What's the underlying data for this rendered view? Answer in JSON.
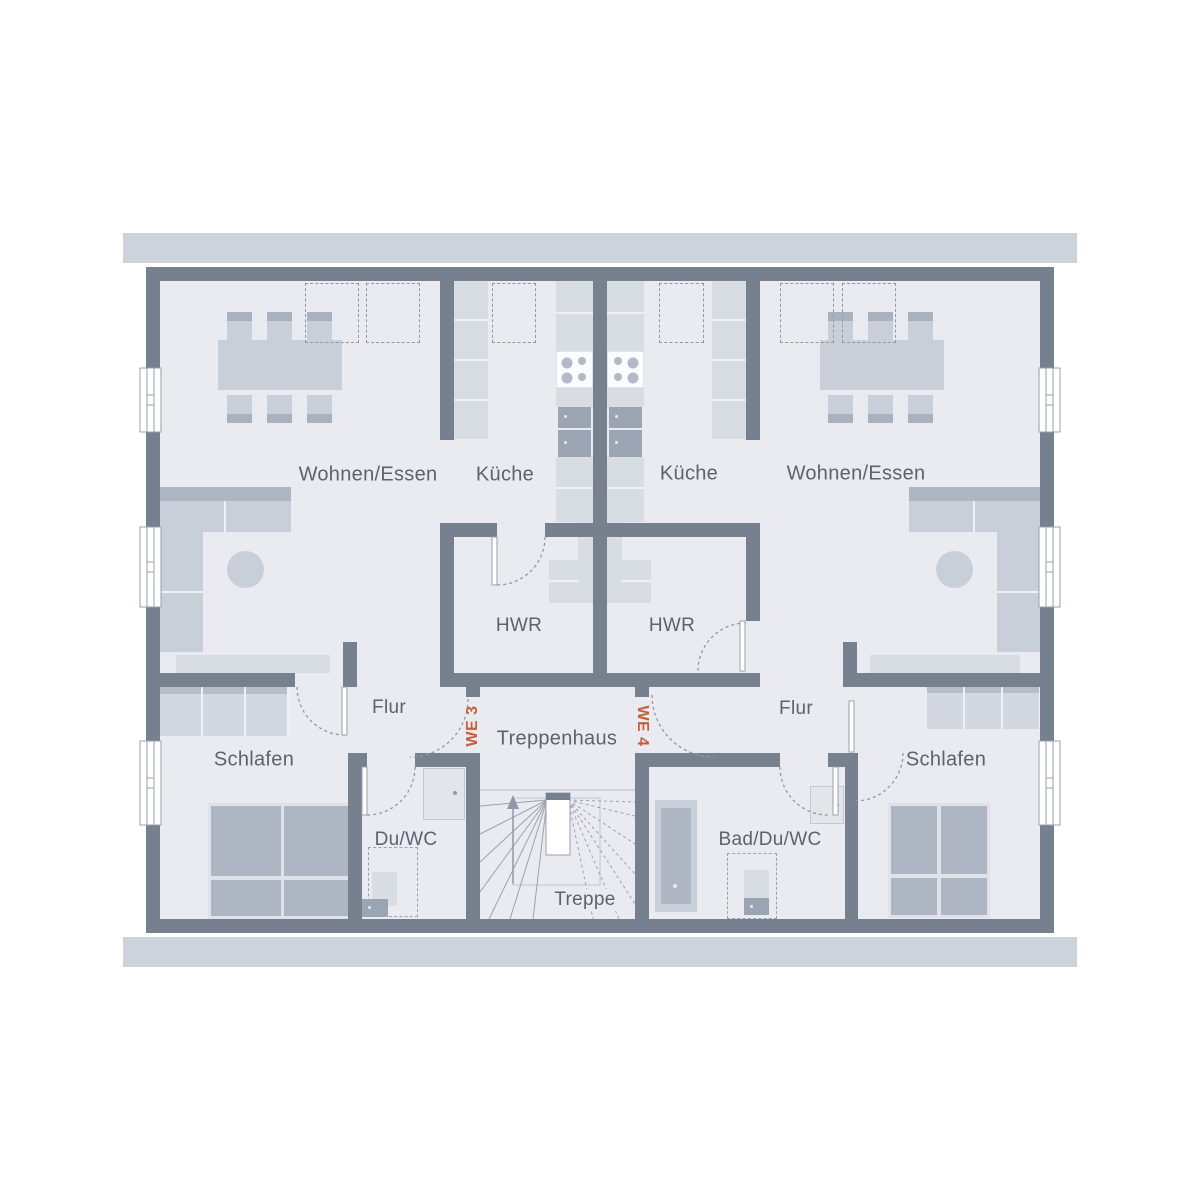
{
  "units": {
    "left": "WE 3",
    "right": "WE 4"
  },
  "rooms": {
    "living_left": "Wohnen/Essen",
    "kitchen_left": "Küche",
    "kitchen_right": "Küche",
    "living_right": "Wohnen/Essen",
    "utility_left": "HWR",
    "utility_right": "HWR",
    "hallway_left": "Flur",
    "hallway_right": "Flur",
    "bedroom_left": "Schlafen",
    "bedroom_right": "Schlafen",
    "bath_left": "Du/WC",
    "bath_right": "Bad/Du/WC",
    "stairhall": "Treppenhaus",
    "stairs": "Treppe"
  },
  "colors": {
    "wall": "#76808f",
    "floor": "#e9ebf1",
    "roof_band": "#ced3db",
    "furniture_light": "#d8dce3",
    "furniture_dark": "#aeb6c3",
    "accent": "#c75f3d",
    "label": "#5b6270"
  }
}
